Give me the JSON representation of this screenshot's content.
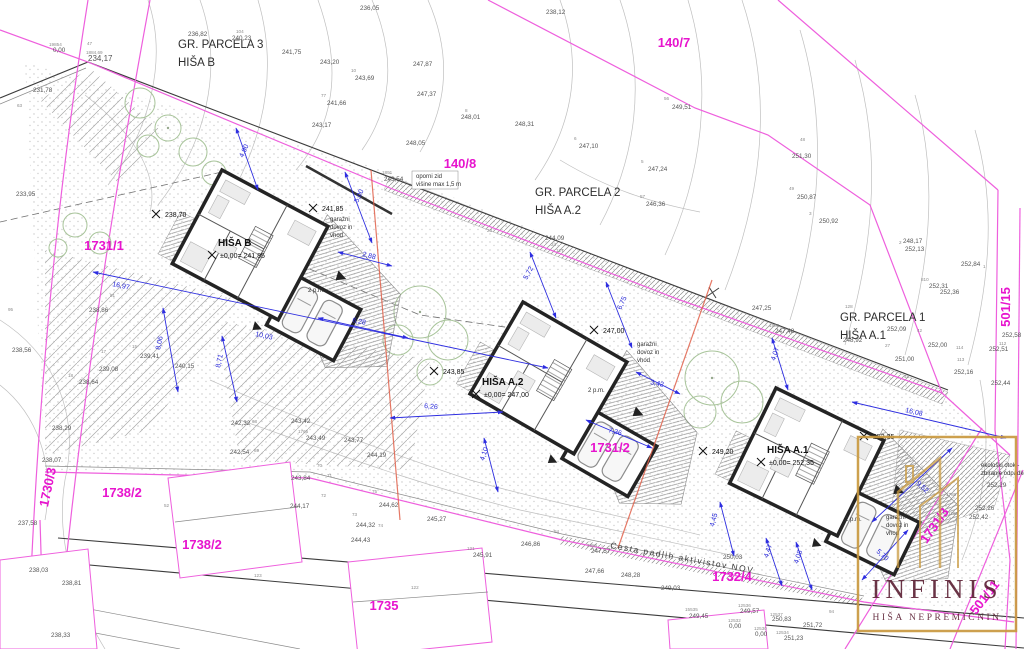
{
  "logo": {
    "title": "INFINIS",
    "subtitle": "HIŠA NEPREMIČNIN"
  },
  "street": {
    "text": "Cesta padlih aktivistov NOV",
    "x": 610,
    "y": 548,
    "rot": 10
  },
  "colors": {
    "magenta": "#e714ce",
    "blue": "#2626d8",
    "gold": "#c9993f",
    "maroon": "#5e2337",
    "section_red": "#e0604a"
  },
  "parcel_numbers": [
    {
      "text": "140/7",
      "x": 674,
      "y": 47,
      "rot": 0
    },
    {
      "text": "140/8",
      "x": 460,
      "y": 168,
      "rot": 0
    },
    {
      "text": "1731/1",
      "x": 104,
      "y": 250,
      "rot": 0
    },
    {
      "text": "1731/2",
      "x": 610,
      "y": 452,
      "rot": 0
    },
    {
      "text": "1738/2",
      "x": 122,
      "y": 497,
      "rot": 0
    },
    {
      "text": "1738/2",
      "x": 202,
      "y": 549,
      "rot": 0
    },
    {
      "text": "1735",
      "x": 384,
      "y": 610,
      "rot": 0
    },
    {
      "text": "1732/4",
      "x": 732,
      "y": 581,
      "rot": 0
    },
    {
      "text": "501/15",
      "x": 1010,
      "y": 307,
      "rot": -90
    },
    {
      "text": "501/11",
      "x": 988,
      "y": 600,
      "rot": -52
    },
    {
      "text": "1730/3",
      "x": 52,
      "y": 488,
      "rot": -78
    },
    {
      "text": "1731/3",
      "x": 938,
      "y": 528,
      "rot": -55
    }
  ],
  "area_titles": [
    {
      "text": "GR. PARCELA 3",
      "x": 178,
      "y": 48
    },
    {
      "text": "HIŠA B",
      "x": 178,
      "y": 66
    },
    {
      "text": "GR. PARCELA 2",
      "x": 535,
      "y": 196
    },
    {
      "text": "HIŠA A.2",
      "x": 535,
      "y": 214
    },
    {
      "text": "GR. PARCELA 1",
      "x": 840,
      "y": 321
    },
    {
      "text": "HIŠA A.1",
      "x": 840,
      "y": 339
    }
  ],
  "house_labels": [
    {
      "name": "HIŠA B",
      "level": "±0,00= 241,85",
      "x": 218,
      "y": 246
    },
    {
      "name": "HIŠA A.2",
      "level": "±0,00= 247,00",
      "x": 482,
      "y": 385
    },
    {
      "name": "HIŠA A.1",
      "level": "±0,00= 252,35",
      "x": 767,
      "y": 453
    }
  ],
  "spot_elevations": [
    {
      "text": "238,70",
      "x": 165,
      "y": 217
    },
    {
      "text": "241,85",
      "x": 322,
      "y": 211
    },
    {
      "text": "243,85",
      "x": 443,
      "y": 374
    },
    {
      "text": "247,00",
      "x": 603,
      "y": 333
    },
    {
      "text": "249,20",
      "x": 712,
      "y": 454
    },
    {
      "text": "252,35",
      "x": 873,
      "y": 439
    }
  ],
  "notes": [
    {
      "text": "garažni",
      "x": 330,
      "y": 221
    },
    {
      "text": "dovoz in",
      "x": 330,
      "y": 229
    },
    {
      "text": "vhod",
      "x": 330,
      "y": 237
    },
    {
      "text": "garažni",
      "x": 637,
      "y": 346
    },
    {
      "text": "dovoz in",
      "x": 637,
      "y": 354
    },
    {
      "text": "vhod",
      "x": 637,
      "y": 362
    },
    {
      "text": "garažni",
      "x": 886,
      "y": 519
    },
    {
      "text": "dovoz in",
      "x": 886,
      "y": 527
    },
    {
      "text": "vhod",
      "x": 886,
      "y": 535
    },
    {
      "text": "2 p.m.",
      "x": 308,
      "y": 292
    },
    {
      "text": "2 p.m.",
      "x": 588,
      "y": 392
    },
    {
      "text": "2 p.m.",
      "x": 845,
      "y": 521
    },
    {
      "text": "oporni zid",
      "x": 416,
      "y": 178
    },
    {
      "text": "višine max 1,5 m",
      "x": 416,
      "y": 186
    },
    {
      "text": "ekološki otok -",
      "x": 981,
      "y": 467
    },
    {
      "text": "zbiranje odpadkov",
      "x": 981,
      "y": 475
    }
  ],
  "dimensions": [
    {
      "text": "16,97",
      "x": 112,
      "y": 286,
      "rot": 12
    },
    {
      "text": "10,03",
      "x": 255,
      "y": 336,
      "rot": 12
    },
    {
      "text": "5,00",
      "x": 358,
      "y": 203,
      "rot": -65
    },
    {
      "text": "4,90",
      "x": 243,
      "y": 158,
      "rot": -65
    },
    {
      "text": "2,88",
      "x": 362,
      "y": 256,
      "rot": 15
    },
    {
      "text": "6,28",
      "x": 352,
      "y": 322,
      "rot": 12
    },
    {
      "text": "6,26",
      "x": 424,
      "y": 408,
      "rot": 5
    },
    {
      "text": "5,72",
      "x": 527,
      "y": 280,
      "rot": -62
    },
    {
      "text": "6,75",
      "x": 621,
      "y": 310,
      "rot": -65
    },
    {
      "text": "8,06",
      "x": 160,
      "y": 350,
      "rot": -78
    },
    {
      "text": "8,71",
      "x": 220,
      "y": 368,
      "rot": -78
    },
    {
      "text": "16,08",
      "x": 905,
      "y": 412,
      "rot": 13
    },
    {
      "text": "9,52",
      "x": 916,
      "y": 484,
      "rot": 42
    },
    {
      "text": "5,70",
      "x": 876,
      "y": 552,
      "rot": 42
    },
    {
      "text": "4,45",
      "x": 714,
      "y": 527,
      "rot": -75
    },
    {
      "text": "4,47",
      "x": 768,
      "y": 558,
      "rot": -72
    },
    {
      "text": "4,08",
      "x": 798,
      "y": 564,
      "rot": -72
    },
    {
      "text": "4,07",
      "x": 775,
      "y": 361,
      "rot": -72
    },
    {
      "text": "3,42",
      "x": 650,
      "y": 384,
      "rot": 12
    },
    {
      "text": "7,36",
      "x": 608,
      "y": 432,
      "rot": 15
    },
    {
      "text": "4,10",
      "x": 484,
      "y": 461,
      "rot": -72
    }
  ],
  "contour_elevations": [
    {
      "text": "236,05",
      "x": 360,
      "y": 10
    },
    {
      "text": "238,12",
      "x": 546,
      "y": 14
    },
    {
      "text": "236,82",
      "x": 188,
      "y": 36
    },
    {
      "text": "240,23",
      "x": 232,
      "y": 40
    },
    {
      "text": "241,75",
      "x": 282,
      "y": 54
    },
    {
      "text": "243,20",
      "x": 320,
      "y": 64
    },
    {
      "text": "243,69",
      "x": 355,
      "y": 80
    },
    {
      "text": "241,66",
      "x": 327,
      "y": 105
    },
    {
      "text": "243,17",
      "x": 312,
      "y": 127
    },
    {
      "text": "247,87",
      "x": 413,
      "y": 66
    },
    {
      "text": "247,37",
      "x": 417,
      "y": 96
    },
    {
      "text": "248,05",
      "x": 406,
      "y": 145
    },
    {
      "text": "243,54",
      "x": 384,
      "y": 181
    },
    {
      "text": "248,01",
      "x": 461,
      "y": 119
    },
    {
      "text": "248,31",
      "x": 515,
      "y": 126
    },
    {
      "text": "247,10",
      "x": 579,
      "y": 148
    },
    {
      "text": "247,24",
      "x": 648,
      "y": 171
    },
    {
      "text": "246,36",
      "x": 646,
      "y": 206
    },
    {
      "text": "249,51",
      "x": 672,
      "y": 109
    },
    {
      "text": "244,09",
      "x": 545,
      "y": 240
    },
    {
      "text": "251,30",
      "x": 792,
      "y": 158
    },
    {
      "text": "250,87",
      "x": 797,
      "y": 199
    },
    {
      "text": "250,92",
      "x": 819,
      "y": 223
    },
    {
      "text": "252,13",
      "x": 905,
      "y": 251
    },
    {
      "text": "252,84",
      "x": 961,
      "y": 266
    },
    {
      "text": "252,31",
      "x": 929,
      "y": 288
    },
    {
      "text": "252,36",
      "x": 940,
      "y": 294
    },
    {
      "text": "252,09",
      "x": 887,
      "y": 331
    },
    {
      "text": "252,00",
      "x": 928,
      "y": 347
    },
    {
      "text": "251,00",
      "x": 895,
      "y": 361
    },
    {
      "text": "248,92",
      "x": 843,
      "y": 342
    },
    {
      "text": "248,17",
      "x": 903,
      "y": 243
    },
    {
      "text": "252,16",
      "x": 954,
      "y": 374
    },
    {
      "text": "252,44",
      "x": 991,
      "y": 385
    },
    {
      "text": "252,58",
      "x": 1002,
      "y": 337
    },
    {
      "text": "252,51",
      "x": 989,
      "y": 351
    },
    {
      "text": "252,29",
      "x": 987,
      "y": 487
    },
    {
      "text": "252,26",
      "x": 975,
      "y": 510
    },
    {
      "text": "252,42",
      "x": 969,
      "y": 519
    },
    {
      "text": "247,48",
      "x": 775,
      "y": 333
    },
    {
      "text": "247,25",
      "x": 752,
      "y": 310
    },
    {
      "text": "233,95",
      "x": 16,
      "y": 196
    },
    {
      "text": "238,86",
      "x": 89,
      "y": 312
    },
    {
      "text": "238,56",
      "x": 12,
      "y": 352
    },
    {
      "text": "239,41",
      "x": 140,
      "y": 358
    },
    {
      "text": "239,08",
      "x": 99,
      "y": 371
    },
    {
      "text": "238,64",
      "x": 79,
      "y": 384
    },
    {
      "text": "240,15",
      "x": 175,
      "y": 368
    },
    {
      "text": "238,29",
      "x": 52,
      "y": 430
    },
    {
      "text": "238,07",
      "x": 42,
      "y": 462
    },
    {
      "text": "237,58",
      "x": 18,
      "y": 525
    },
    {
      "text": "238,03",
      "x": 29,
      "y": 572
    },
    {
      "text": "238,81",
      "x": 62,
      "y": 585
    },
    {
      "text": "238,33",
      "x": 51,
      "y": 637
    },
    {
      "text": "242,32",
      "x": 231,
      "y": 425
    },
    {
      "text": "242,54",
      "x": 230,
      "y": 454
    },
    {
      "text": "243,42",
      "x": 291,
      "y": 423
    },
    {
      "text": "243,49",
      "x": 306,
      "y": 440
    },
    {
      "text": "243,77",
      "x": 344,
      "y": 442
    },
    {
      "text": "244,19",
      "x": 367,
      "y": 457
    },
    {
      "text": "243,84",
      "x": 291,
      "y": 480
    },
    {
      "text": "244,17",
      "x": 290,
      "y": 508
    },
    {
      "text": "244,62",
      "x": 379,
      "y": 507
    },
    {
      "text": "245,27",
      "x": 427,
      "y": 521
    },
    {
      "text": "244,32",
      "x": 356,
      "y": 527
    },
    {
      "text": "244,43",
      "x": 351,
      "y": 542
    },
    {
      "text": "245,91",
      "x": 473,
      "y": 557
    },
    {
      "text": "246,86",
      "x": 521,
      "y": 546
    },
    {
      "text": "247,57",
      "x": 591,
      "y": 553
    },
    {
      "text": "247,66",
      "x": 585,
      "y": 573
    },
    {
      "text": "248,28",
      "x": 621,
      "y": 577
    },
    {
      "text": "249,03",
      "x": 661,
      "y": 590
    },
    {
      "text": "249,45",
      "x": 689,
      "y": 618
    },
    {
      "text": "249,57",
      "x": 740,
      "y": 613
    },
    {
      "text": "250,83",
      "x": 772,
      "y": 621
    },
    {
      "text": "251,72",
      "x": 803,
      "y": 627
    },
    {
      "text": "251,23",
      "x": 784,
      "y": 640
    },
    {
      "text": "250,03",
      "x": 723,
      "y": 559
    },
    {
      "text": "234,17",
      "x": 88,
      "y": 61,
      "size": 8
    },
    {
      "text": "231,78",
      "x": 33,
      "y": 92
    },
    {
      "text": "0,00",
      "x": 53,
      "y": 52
    },
    {
      "text": "0,00",
      "x": 729,
      "y": 628
    },
    {
      "text": "0,00",
      "x": 755,
      "y": 636
    }
  ],
  "point_numbers": [
    {
      "text": "104",
      "x": 236,
      "y": 33
    },
    {
      "text": "77",
      "x": 321,
      "y": 97
    },
    {
      "text": "10",
      "x": 351,
      "y": 72
    },
    {
      "text": "23",
      "x": 487,
      "y": 232
    },
    {
      "text": "24",
      "x": 551,
      "y": 246
    },
    {
      "text": "127",
      "x": 556,
      "y": 252
    },
    {
      "text": "42",
      "x": 917,
      "y": 332
    },
    {
      "text": "27",
      "x": 885,
      "y": 347
    },
    {
      "text": "43",
      "x": 904,
      "y": 378
    },
    {
      "text": "128",
      "x": 845,
      "y": 308
    },
    {
      "text": "113",
      "x": 957,
      "y": 361
    },
    {
      "text": "114",
      "x": 956,
      "y": 349
    },
    {
      "text": "112",
      "x": 999,
      "y": 345
    },
    {
      "text": "810",
      "x": 921,
      "y": 281
    },
    {
      "text": "8",
      "x": 465,
      "y": 112
    },
    {
      "text": "6",
      "x": 574,
      "y": 140
    },
    {
      "text": "5",
      "x": 641,
      "y": 163
    },
    {
      "text": "57",
      "x": 640,
      "y": 198
    },
    {
      "text": "48",
      "x": 800,
      "y": 141
    },
    {
      "text": "49",
      "x": 789,
      "y": 190
    },
    {
      "text": "56",
      "x": 664,
      "y": 100
    },
    {
      "text": "52",
      "x": 164,
      "y": 507
    },
    {
      "text": "123",
      "x": 254,
      "y": 577
    },
    {
      "text": "68",
      "x": 252,
      "y": 423
    },
    {
      "text": "69",
      "x": 254,
      "y": 452
    },
    {
      "text": "91",
      "x": 110,
      "y": 297
    },
    {
      "text": "95",
      "x": 8,
      "y": 311
    },
    {
      "text": "84",
      "x": 554,
      "y": 533
    },
    {
      "text": "94",
      "x": 829,
      "y": 613
    },
    {
      "text": "121",
      "x": 467,
      "y": 550
    },
    {
      "text": "122",
      "x": 411,
      "y": 589
    },
    {
      "text": "70",
      "x": 317,
      "y": 467
    },
    {
      "text": "71",
      "x": 327,
      "y": 477
    },
    {
      "text": "72",
      "x": 321,
      "y": 497
    },
    {
      "text": "73",
      "x": 352,
      "y": 516
    },
    {
      "text": "74",
      "x": 378,
      "y": 527
    },
    {
      "text": "75",
      "x": 372,
      "y": 493
    },
    {
      "text": "15",
      "x": 132,
      "y": 348
    },
    {
      "text": "17",
      "x": 101,
      "y": 353
    },
    {
      "text": "18",
      "x": 68,
      "y": 377
    },
    {
      "text": "47",
      "x": 87,
      "y": 45
    },
    {
      "text": "63",
      "x": 17,
      "y": 107
    },
    {
      "text": "1891",
      "x": 382,
      "y": 174
    },
    {
      "text": "1765",
      "x": 298,
      "y": 433
    },
    {
      "text": "1980",
      "x": 769,
      "y": 327
    },
    {
      "text": "3885",
      "x": 587,
      "y": 547
    },
    {
      "text": "12536",
      "x": 738,
      "y": 607
    },
    {
      "text": "12537",
      "x": 770,
      "y": 616
    },
    {
      "text": "12532",
      "x": 728,
      "y": 622
    },
    {
      "text": "12530",
      "x": 754,
      "y": 630
    },
    {
      "text": "12534",
      "x": 776,
      "y": 634
    },
    {
      "text": "15535",
      "x": 685,
      "y": 611
    },
    {
      "text": "1884,69",
      "x": 86,
      "y": 54
    },
    {
      "text": "19854",
      "x": 49,
      "y": 46
    },
    {
      "text": "1788",
      "x": 946,
      "y": 496
    },
    {
      "text": "1793",
      "x": 948,
      "y": 515
    },
    {
      "text": "1",
      "x": 983,
      "y": 268
    },
    {
      "text": "2",
      "x": 899,
      "y": 244
    },
    {
      "text": "3",
      "x": 809,
      "y": 215
    }
  ]
}
